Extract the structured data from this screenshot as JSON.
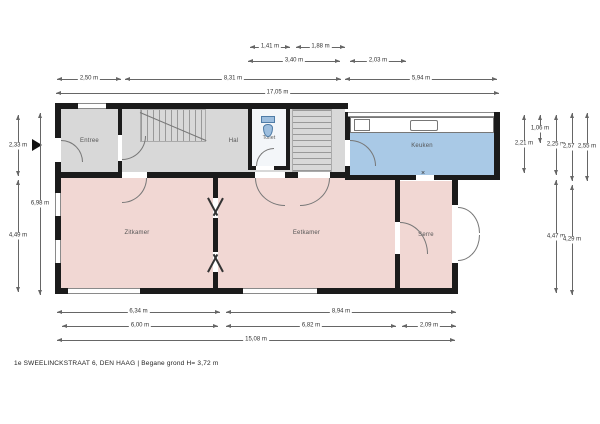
{
  "caption": "1e SWEELINCKSTRAAT 6, DEN HAAG | Begane grond H= 3,72 m",
  "colors": {
    "wall": "#1b1b1b",
    "hall": "#d8d8d8",
    "living": "#f1d7d3",
    "kitchen": "#a9c9e6",
    "toilet": "#f3f6f9",
    "dim_line": "#666666"
  },
  "rooms": [
    {
      "name": "Entree",
      "type": "hall",
      "x": 61,
      "y": 109,
      "w": 57,
      "h": 63
    },
    {
      "name": "Hal",
      "type": "hall",
      "x": 122,
      "y": 109,
      "w": 223,
      "h": 63
    },
    {
      "name": "Toilet",
      "type": "toilet",
      "x": 252,
      "y": 109,
      "w": 34,
      "h": 57,
      "small": true
    },
    {
      "name": "Keuken",
      "type": "kitchen",
      "x": 350,
      "y": 117,
      "w": 144,
      "h": 58
    },
    {
      "name": "Zitkamer",
      "type": "living",
      "x": 61,
      "y": 178,
      "w": 152,
      "h": 110
    },
    {
      "name": "Eetkamer",
      "type": "living",
      "x": 218,
      "y": 178,
      "w": 177,
      "h": 110
    },
    {
      "name": "Serre",
      "type": "living",
      "x": 400,
      "y": 181,
      "w": 52,
      "h": 107
    }
  ],
  "dimensions": [
    {
      "orient": "h",
      "x": 250,
      "y": 47,
      "len": 40,
      "label": "1,41 m"
    },
    {
      "orient": "h",
      "x": 296,
      "y": 47,
      "len": 49,
      "label": "1,88 m"
    },
    {
      "orient": "h",
      "x": 248,
      "y": 61,
      "len": 92,
      "label": "3,40 m"
    },
    {
      "orient": "h",
      "x": 350,
      "y": 61,
      "len": 56,
      "label": "2,03 m"
    },
    {
      "orient": "h",
      "x": 57,
      "y": 79,
      "len": 64,
      "label": "2,50 m"
    },
    {
      "orient": "h",
      "x": 125,
      "y": 79,
      "len": 216,
      "label": "8,31 m"
    },
    {
      "orient": "h",
      "x": 345,
      "y": 79,
      "len": 152,
      "label": "5,94 m"
    },
    {
      "orient": "h",
      "x": 56,
      "y": 93,
      "len": 443,
      "label": "17,05 m"
    },
    {
      "orient": "h",
      "x": 57,
      "y": 312,
      "len": 163,
      "label": "6,34 m"
    },
    {
      "orient": "h",
      "x": 226,
      "y": 312,
      "len": 230,
      "label": "8,94 m"
    },
    {
      "orient": "h",
      "x": 62,
      "y": 326,
      "len": 156,
      "label": "6,00 m"
    },
    {
      "orient": "h",
      "x": 226,
      "y": 326,
      "len": 170,
      "label": "6,82 m"
    },
    {
      "orient": "h",
      "x": 402,
      "y": 326,
      "len": 54,
      "label": "2,09 m"
    },
    {
      "orient": "h",
      "x": 57,
      "y": 340,
      "len": 398,
      "label": "15,08 m"
    },
    {
      "orient": "v",
      "x": 18,
      "y": 115,
      "len": 61,
      "label": "2,33 m"
    },
    {
      "orient": "v",
      "x": 18,
      "y": 180,
      "len": 112,
      "label": "4,49 m"
    },
    {
      "orient": "v",
      "x": 40,
      "y": 113,
      "len": 182,
      "label": "6,98 m"
    },
    {
      "orient": "v",
      "x": 524,
      "y": 115,
      "len": 58,
      "label": "2,21 m"
    },
    {
      "orient": "v",
      "x": 540,
      "y": 115,
      "len": 28,
      "label": "1,06 m"
    },
    {
      "orient": "v",
      "x": 556,
      "y": 115,
      "len": 60,
      "label": "2,25 m"
    },
    {
      "orient": "v",
      "x": 556,
      "y": 180,
      "len": 113,
      "label": "4,47 m"
    },
    {
      "orient": "v",
      "x": 572,
      "y": 113,
      "len": 68,
      "label": "2,57 m"
    },
    {
      "orient": "v",
      "x": 572,
      "y": 185,
      "len": 110,
      "label": "4,29 m"
    },
    {
      "orient": "v",
      "x": 587,
      "y": 113,
      "len": 68,
      "label": "2,55 m"
    }
  ],
  "markers": {
    "door_cross": "×"
  }
}
